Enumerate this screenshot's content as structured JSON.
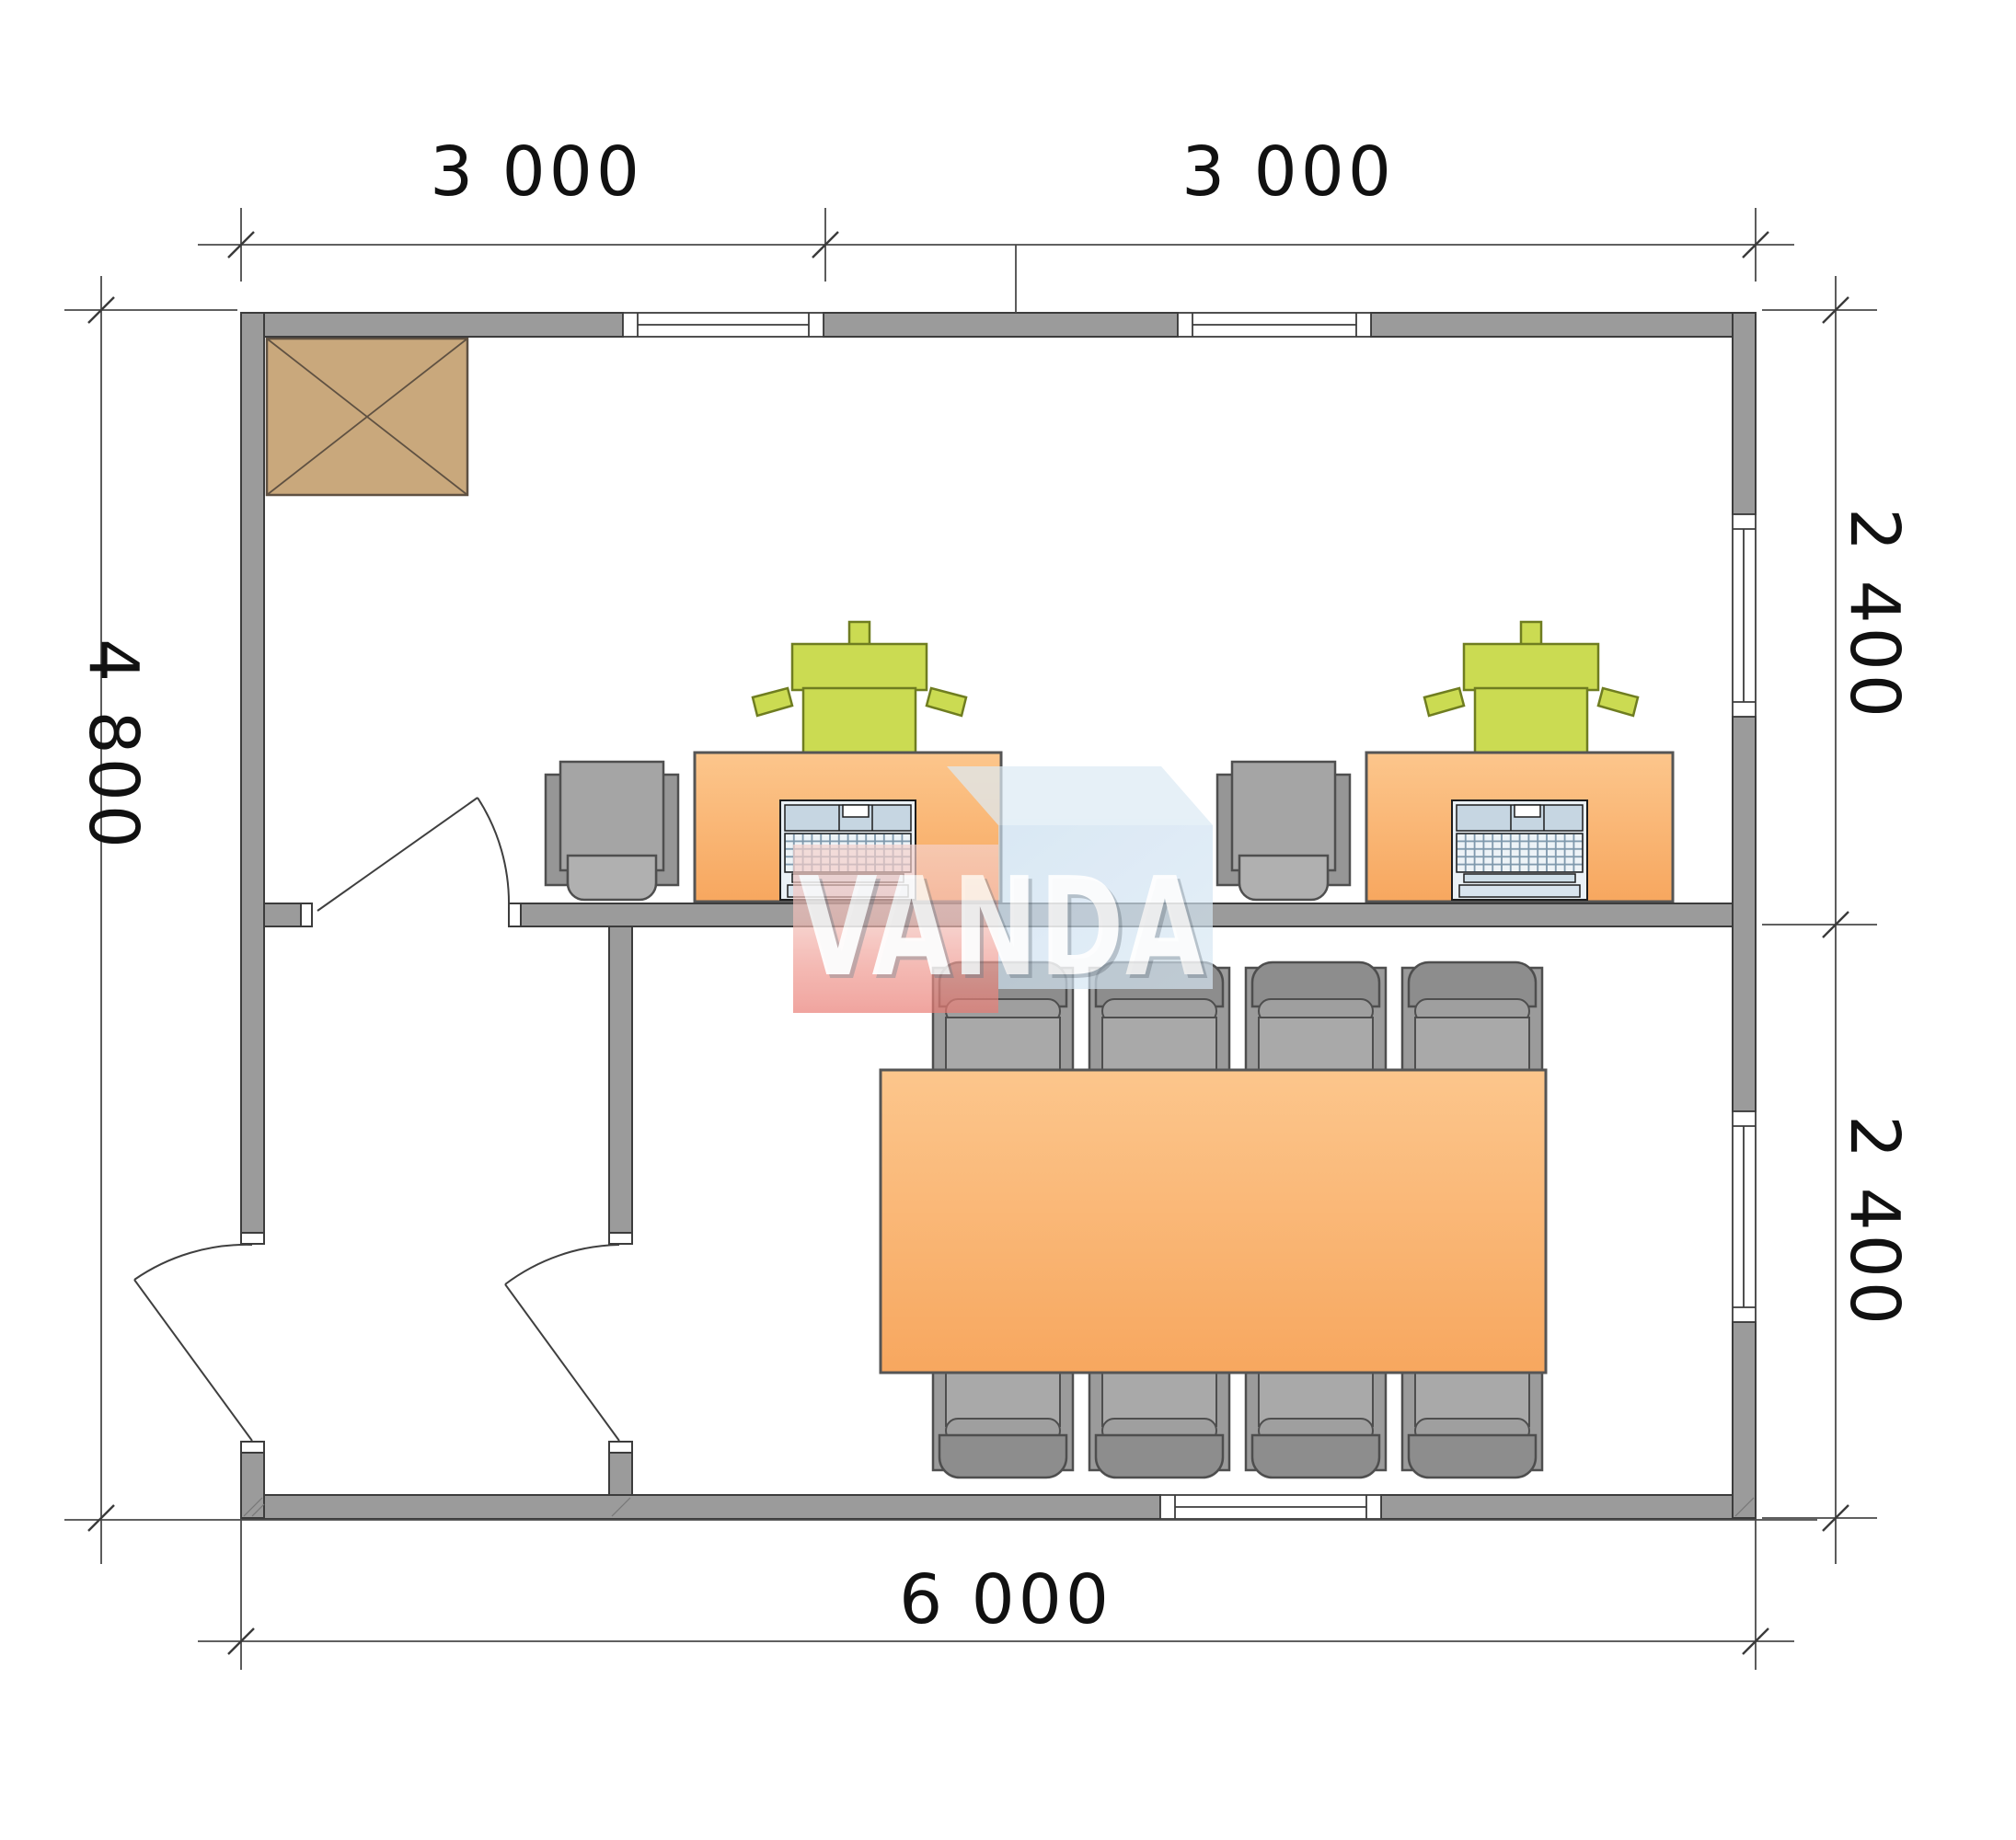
{
  "plan": {
    "dimensions": {
      "top": [
        "3 000",
        "3 000"
      ],
      "left": "4 800",
      "right_upper": "2 400",
      "right_lower": "2 400",
      "bottom": "6 000"
    },
    "watermark": "VANDA",
    "colors": {
      "wall": "#9B9B9B",
      "desk": "#F9B26B",
      "table": "#F9B26B",
      "chair_green": "#CBDB52",
      "chair_gray": "#A5A5A5",
      "heater": "#C9A87C",
      "logo_pink": "#ED8E86",
      "logo_blue": "#C4DAEC",
      "logo_text": "#FFFFFF"
    }
  }
}
